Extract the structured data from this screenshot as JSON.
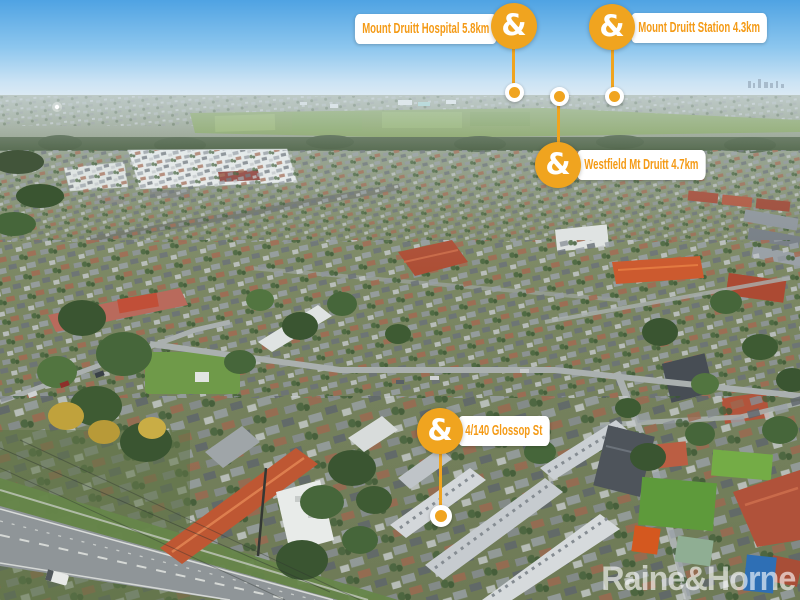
{
  "markers": [
    {
      "id": "mount-druitt-hospital",
      "name": "Mount Druitt Hospital",
      "distance": "5.8km",
      "label": "Mount Druitt Hospital 5.8km"
    },
    {
      "id": "mount-druitt-station",
      "name": "Mount Druitt Station",
      "distance": "4.3km",
      "label": "Mount Druitt Station 4.3km"
    },
    {
      "id": "westfield-mt-druitt",
      "name": "Westfield Mt Druitt",
      "distance": "4.7km",
      "label": "Westfield Mt Druitt 4.7km"
    },
    {
      "id": "property-address",
      "name": "4/140 Glossop St",
      "distance": "",
      "label": "4/140 Glossop St"
    }
  ],
  "badge_glyph": "&",
  "watermark": "Raine&Horne",
  "colors": {
    "brand_orange": "#F0A41F",
    "pin_text_orange": "#F49A15",
    "pin_background": "#FFFFFF",
    "watermark_white": "rgba(255,255,255,0.62)"
  }
}
